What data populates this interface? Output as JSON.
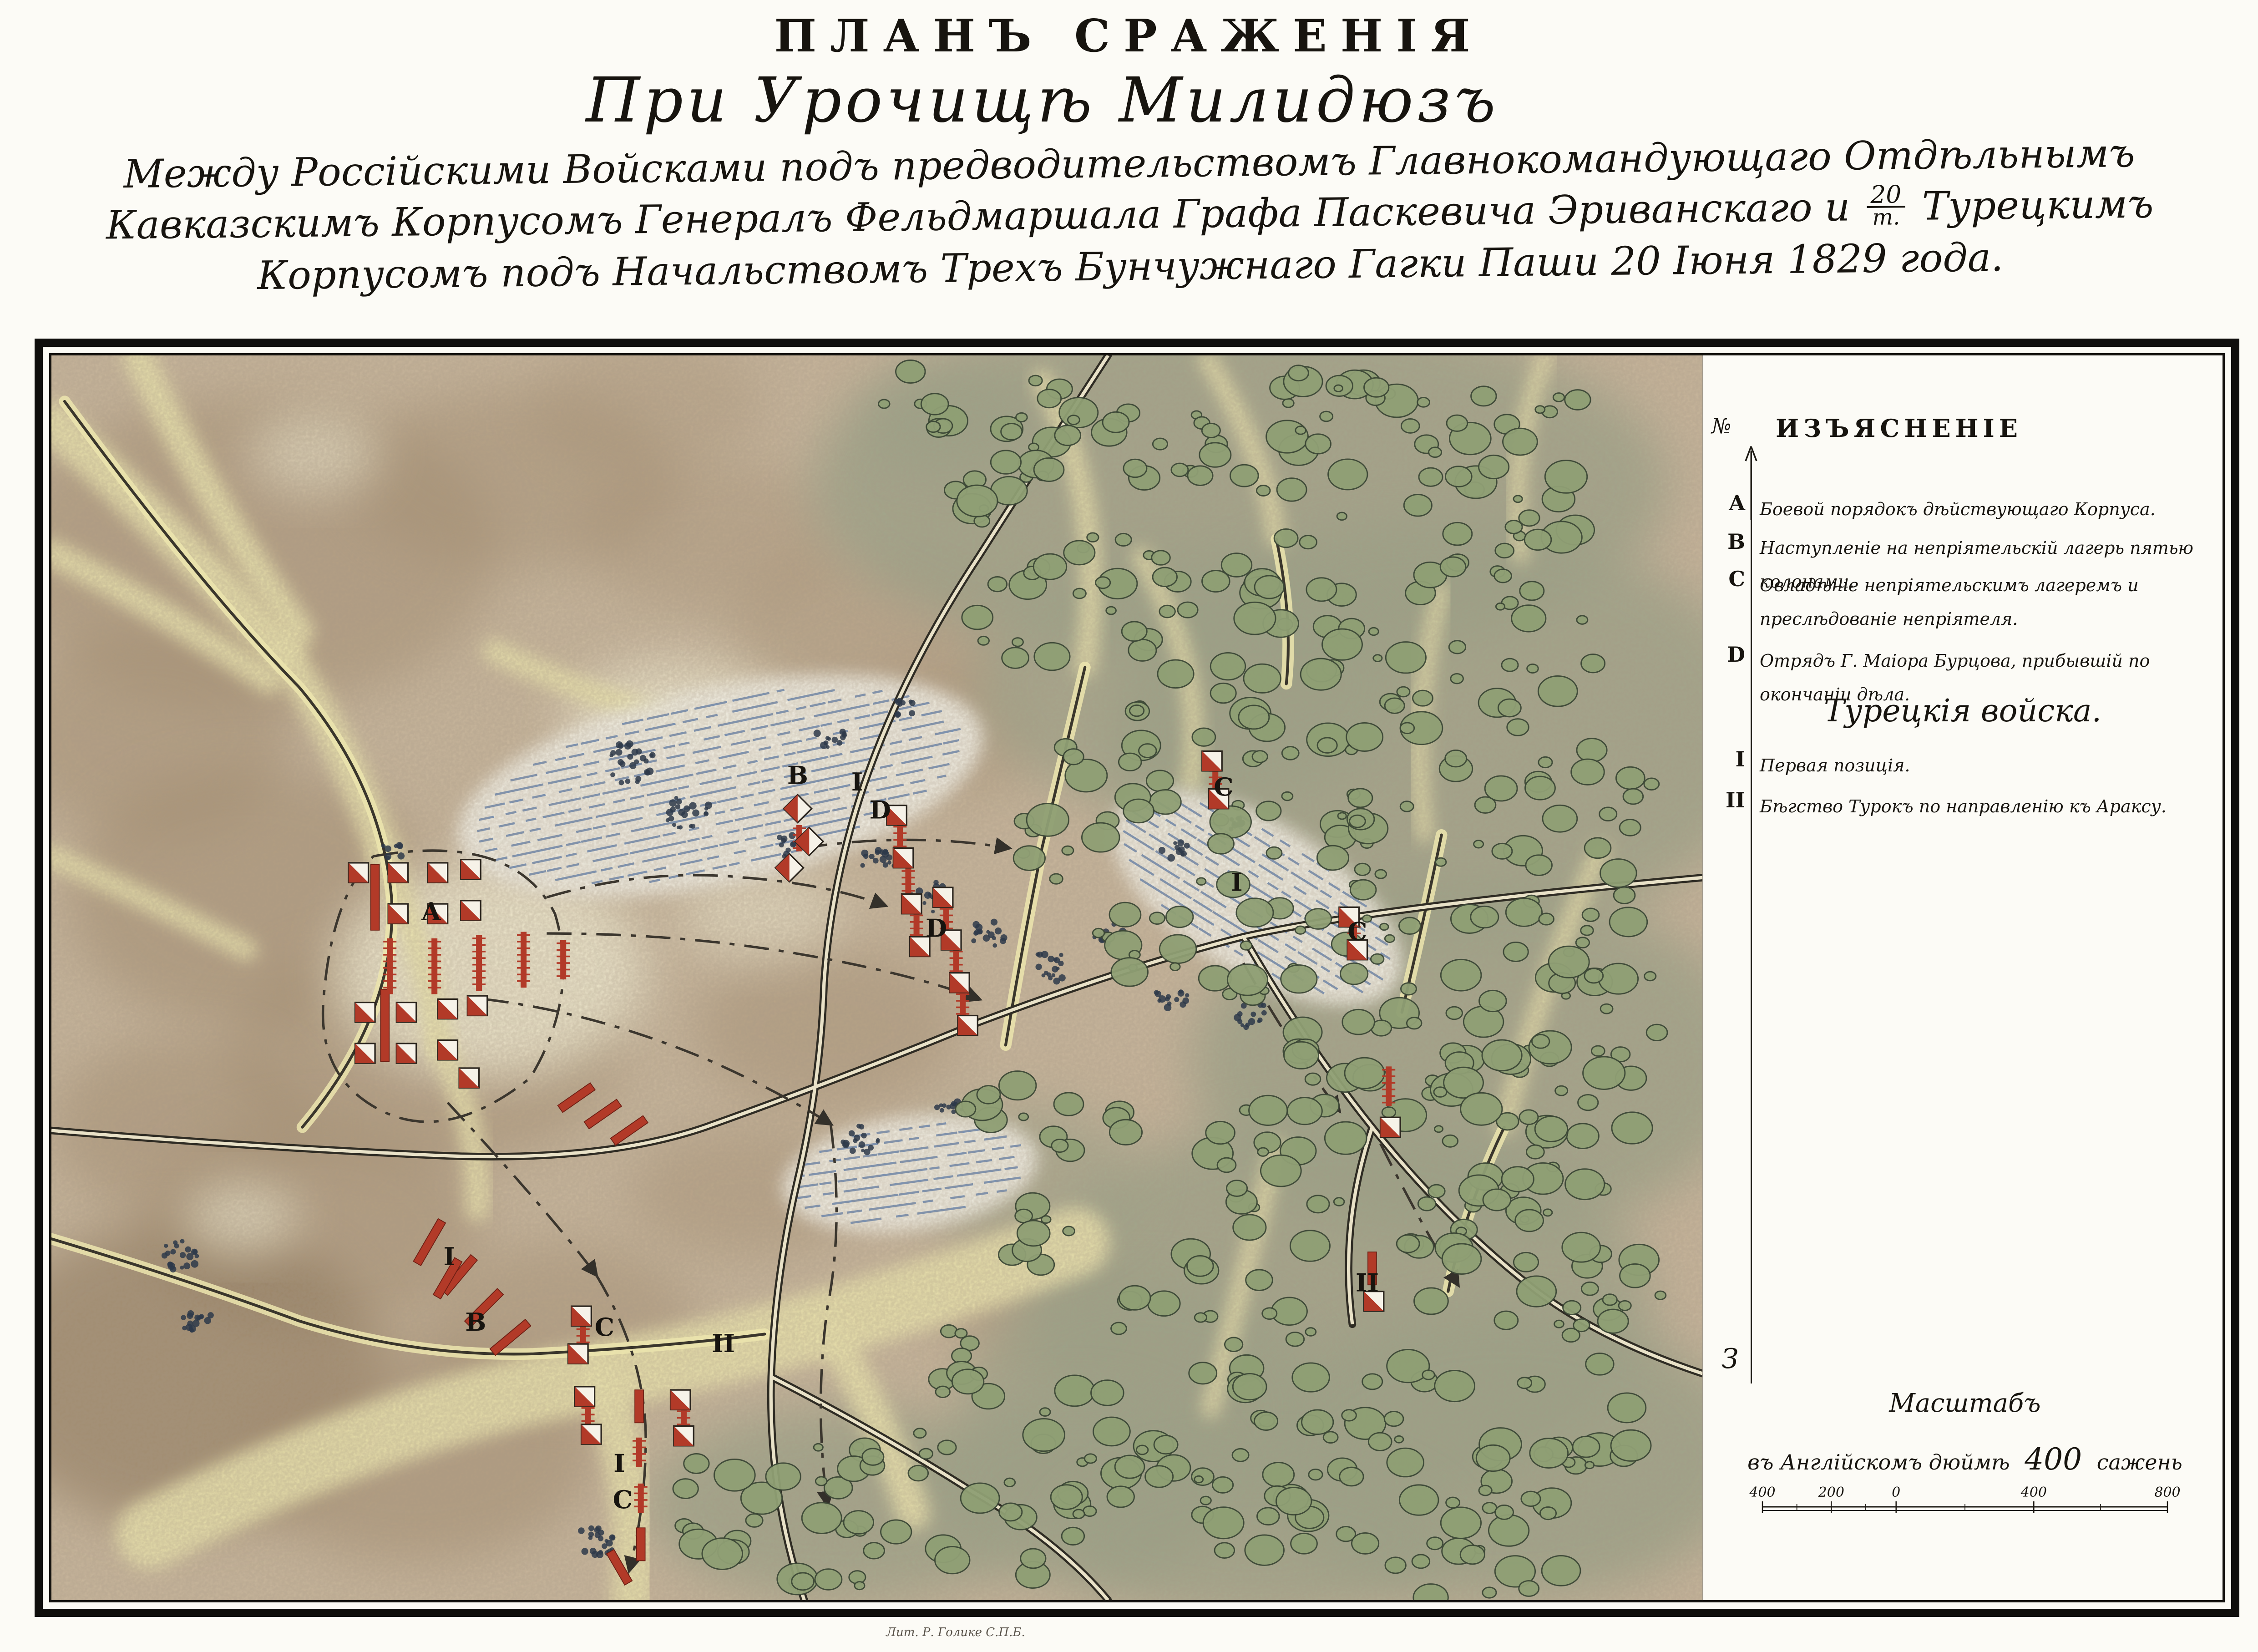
{
  "title_block": {
    "title": "ПЛАНЪ  СРАЖЕНІЯ",
    "subtitle": "При Урочищѣ  Милидюзъ",
    "line3": "Между Россійскими Войсками подъ предводительствомъ Главнокомандующаго Отдѣльнымъ",
    "line4_pre": "Кавказскимъ Корпусомъ Генералъ Фельдмаршала Графа Паскевича Эриванскаго и",
    "line4_frac_num": "20",
    "line4_frac_den": "т.",
    "line4_post": "Турецкимъ",
    "line5": "Корпусомъ подъ Начальствомъ Трехъ Бунчужнаго Гагки Паши  20 Іюня 1829 года."
  },
  "legend": {
    "north_label": "№",
    "header": "ИЗЪЯСНЕНІЕ",
    "items": [
      {
        "key": "A",
        "text": "Боевой порядокъ дѣйствующаго Корпуса."
      },
      {
        "key": "B",
        "text": "Наступленіе на непріятельскій лагерь пятью колонами."
      },
      {
        "key": "C",
        "text": "Овладѣніе непріятельскимъ лагеремъ и преслѣдованіе непріятеля."
      },
      {
        "key": "D",
        "text": "Отрядъ Г. Маіора Бурцова, прибывшій по окончаніи дѣла."
      }
    ],
    "subheader": "Турецкія войска.",
    "items2": [
      {
        "key": "I",
        "text": "Первая позиція."
      },
      {
        "key": "II",
        "text": "Бѣгство Турокъ по направленію къ Араксу."
      }
    ],
    "sheet_mark": "З"
  },
  "scale": {
    "title": "Масштабъ",
    "caption_pre": "въ Англійскомъ дюймѣ",
    "caption_value": "400",
    "caption_post": "сажень",
    "bar_labels": [
      [
        "400",
        0
      ],
      [
        "200",
        0.17
      ],
      [
        "0",
        0.33
      ],
      [
        "400",
        0.67
      ],
      [
        "800",
        1
      ]
    ],
    "minor_ticks": [
      0.085,
      0.255,
      0.5,
      0.835
    ]
  },
  "imprint": "Лит. Р. Голике С.П.Б.",
  "map": {
    "colors": {
      "terrain": "#c8b69c",
      "hill": "#a18a6d",
      "hill_dark": "#8a7356",
      "cream": "#f2ecd2",
      "valley": "#ece5ae",
      "forest_base": "#9aa287",
      "tree": "#8f9f74",
      "tree_outline": "#3c4836",
      "marsh_blue": "#7591b8",
      "marsh_ground": "#f6f4ea",
      "river": "#3a362c",
      "road": "#2f2c24",
      "road_fill": "#e9e2c8",
      "route": "#3b362e",
      "unit_red": "#b23a28",
      "flag_face": "#f6f2e8",
      "dot_scrub": "#2e3a4a",
      "label_ink": "#17140f"
    },
    "washes": [
      [
        120,
        120,
        150,
        95,
        "hill",
        0.5
      ],
      [
        280,
        75,
        100,
        55,
        "hill",
        0.45
      ],
      [
        60,
        230,
        85,
        65,
        "hill",
        0.5
      ],
      [
        120,
        330,
        110,
        80,
        "hill",
        0.55
      ],
      [
        225,
        425,
        120,
        70,
        "hill",
        0.5
      ],
      [
        80,
        470,
        80,
        55,
        "hill",
        0.5
      ],
      [
        160,
        530,
        100,
        65,
        "hill",
        0.55
      ],
      [
        80,
        620,
        120,
        95,
        "hill_dark",
        0.6
      ],
      [
        220,
        665,
        110,
        70,
        "hill",
        0.55
      ],
      [
        310,
        590,
        80,
        50,
        "hill",
        0.45
      ],
      [
        470,
        410,
        80,
        50,
        "hill",
        0.45
      ],
      [
        420,
        510,
        70,
        40,
        "hill",
        0.4
      ],
      [
        500,
        170,
        90,
        55,
        "hill",
        0.35
      ],
      [
        400,
        110,
        80,
        45,
        "hill",
        0.35
      ],
      [
        545,
        230,
        60,
        40,
        "hill",
        0.35
      ],
      [
        360,
        30,
        70,
        40,
        "hill",
        0.3
      ],
      [
        600,
        580,
        60,
        40,
        "hill",
        0.35
      ],
      [
        265,
        375,
        95,
        65,
        "cream",
        0.9
      ],
      [
        380,
        225,
        70,
        40,
        "cream",
        0.8
      ],
      [
        160,
        60,
        40,
        25,
        "cream",
        0.6
      ],
      [
        115,
        525,
        35,
        22,
        "cream",
        0.7
      ],
      [
        430,
        340,
        50,
        28,
        "cream",
        0.6
      ],
      [
        720,
        80,
        260,
        110,
        "forest_base",
        0.8
      ],
      [
        840,
        230,
        200,
        130,
        "forest_base",
        0.8
      ],
      [
        690,
        200,
        130,
        80,
        "forest_base",
        0.7
      ],
      [
        860,
        430,
        170,
        110,
        "forest_base",
        0.8
      ],
      [
        780,
        580,
        190,
        120,
        "forest_base",
        0.8
      ],
      [
        880,
        670,
        150,
        90,
        "forest_base",
        0.85
      ],
      [
        660,
        640,
        110,
        80,
        "forest_base",
        0.75
      ],
      [
        480,
        700,
        120,
        60,
        "forest_base",
        0.8
      ],
      [
        590,
        500,
        70,
        45,
        "forest_base",
        0.6
      ],
      [
        545,
        40,
        55,
        35,
        "forest_base",
        0.7
      ],
      [
        620,
        690,
        90,
        60,
        "forest_base",
        0.8
      ],
      [
        730,
        720,
        120,
        50,
        "forest_base",
        0.8
      ]
    ],
    "valleys": [
      [
        "M 0 40 Q 60 95 140 180",
        24
      ],
      [
        "M 52 0 Q 92 85 150 168",
        18
      ],
      [
        "M 0 120 Q 62 152 132 198",
        16
      ],
      [
        "M 140 180 Q 182 245 202 305",
        20
      ],
      [
        "M 0 305 Q 60 332 118 362",
        13
      ],
      [
        "M 202 305 Q 225 360 235 420",
        16
      ],
      [
        "M 60 718 Q 200 645 330 622 Q 470 596 620 540",
        42
      ],
      [
        "M 330 622 Q 358 680 352 756",
        26
      ],
      [
        "M 470 592 Q 502 645 522 705",
        20
      ],
      [
        "M 235 420 Q 260 470 258 520",
        14
      ],
      [
        "M 600 15 Q 640 90 626 190",
        12
      ],
      [
        "M 700 2 Q 736 62 742 112",
        10
      ],
      [
        "M 660 122 Q 700 192 690 262",
        10
      ],
      [
        "M 905 0 Q 882 62 890 122",
        9
      ],
      [
        "M 842 142 Q 822 222 832 292",
        9
      ],
      [
        "M 938 302 Q 902 382 880 470",
        10
      ],
      [
        "M 742 482 Q 722 562 702 642",
        10
      ],
      [
        "M 268 180 Q 330 210 390 225",
        14
      ],
      [
        "M 390 225 Q 470 240 520 262",
        12
      ]
    ],
    "marshes": [
      [
        405,
        262,
        150,
        52,
        -12
      ],
      [
        730,
        330,
        92,
        40,
        32
      ],
      [
        520,
        498,
        72,
        30,
        -8
      ]
    ],
    "rivers": [
      "M 8 28 Q 90 140 150 202 Q 200 262 206 330",
      "M 206 330 Q 210 400 152 470",
      "M 0 538 Q 80 562 150 588 Q 220 610 292 608 Q 370 604 432 596",
      "M 626 190 Q 612 250 600 300 Q 588 360 578 420",
      "M 842 292 Q 830 350 818 400",
      "M 880 470 Q 856 520 846 570",
      "M 742 112 Q 752 160 748 200"
    ],
    "roads": [
      "M 0 472 Q 120 482 230 487 Q 332 492 396 470 Q 480 440 562 406 Q 652 372 722 354 Q 802 336 1000 318",
      "M 640 0 Q 600 62 562 122 Q 516 192 492 262 Q 472 322 468 382 Q 466 442 452 502 Q 438 562 436 622 Q 434 692 456 758",
      "M 722 354 Q 760 420 800 470 Q 846 528 900 570 Q 940 600 1000 620",
      "M 436 622 Q 500 655 558 692 Q 610 722 640 758",
      "M 800 470 Q 780 530 788 590"
    ],
    "routes": [
      [
        "M 300 330 Q 360 312 420 318 Q 470 322 505 335",
        1
      ],
      [
        "M 300 352 Q 380 352 450 364 Q 520 376 562 392",
        1
      ],
      [
        "M 262 392 Q 330 400 400 430 Q 440 448 472 468",
        1
      ],
      [
        "M 455 300 Q 520 290 580 300",
        1
      ],
      [
        "M 240 455 Q 300 520 330 560",
        1
      ],
      [
        "M 330 560 Q 360 610 360 660 Q 360 700 350 740",
        1
      ],
      [
        "M 472 468 Q 480 530 470 580 Q 462 640 470 700",
        1
      ],
      [
        "M 722 370 Q 750 420 780 460",
        1
      ],
      [
        "M 805 480 Q 830 530 852 566",
        1
      ],
      [
        "M 195 305 Q 280 290 305 340 Q 320 390 290 440 Q 240 480 200 460 Q 160 440 165 390 Q 170 330 195 305",
        0
      ]
    ],
    "forests": [
      [
        640,
        45,
        75,
        40,
        26
      ],
      [
        760,
        55,
        90,
        45,
        30
      ],
      [
        890,
        70,
        70,
        50,
        26
      ],
      [
        620,
        150,
        65,
        50,
        24
      ],
      [
        735,
        165,
        80,
        55,
        28
      ],
      [
        865,
        180,
        70,
        55,
        26
      ],
      [
        680,
        255,
        70,
        50,
        24
      ],
      [
        800,
        270,
        75,
        55,
        26
      ],
      [
        920,
        285,
        55,
        55,
        20
      ],
      [
        745,
        350,
        65,
        45,
        22
      ],
      [
        865,
        385,
        70,
        55,
        24
      ],
      [
        950,
        390,
        40,
        55,
        16
      ],
      [
        800,
        440,
        60,
        45,
        20
      ],
      [
        905,
        470,
        60,
        55,
        20
      ],
      [
        745,
        500,
        55,
        45,
        18
      ],
      [
        855,
        545,
        65,
        55,
        22
      ],
      [
        950,
        575,
        40,
        55,
        16
      ],
      [
        700,
        590,
        55,
        45,
        18
      ],
      [
        790,
        640,
        65,
        50,
        22
      ],
      [
        910,
        660,
        55,
        45,
        18
      ],
      [
        745,
        700,
        65,
        40,
        20
      ],
      [
        860,
        725,
        65,
        35,
        20
      ],
      [
        640,
        665,
        50,
        40,
        16
      ],
      [
        580,
        710,
        50,
        35,
        14
      ],
      [
        420,
        700,
        45,
        35,
        12
      ],
      [
        500,
        665,
        45,
        35,
        12
      ],
      [
        475,
        730,
        45,
        25,
        12
      ],
      [
        545,
        620,
        35,
        28,
        10
      ],
      [
        600,
        530,
        28,
        24,
        8
      ],
      [
        628,
        470,
        24,
        20,
        7
      ],
      [
        575,
        455,
        22,
        18,
        6
      ],
      [
        532,
        30,
        30,
        25,
        8
      ],
      [
        568,
        90,
        26,
        22,
        7
      ],
      [
        660,
        360,
        40,
        30,
        10
      ],
      [
        610,
        300,
        30,
        25,
        8
      ]
    ],
    "dots": [
      [
        350,
        248,
        16,
        26
      ],
      [
        385,
        278,
        14,
        22
      ],
      [
        448,
        298,
        10,
        14
      ],
      [
        500,
        308,
        11,
        16
      ],
      [
        532,
        330,
        12,
        18
      ],
      [
        568,
        352,
        11,
        16
      ],
      [
        605,
        372,
        12,
        18
      ],
      [
        640,
        352,
        9,
        12
      ],
      [
        678,
        390,
        10,
        14
      ],
      [
        728,
        402,
        10,
        14
      ],
      [
        206,
        302,
        7,
        8
      ],
      [
        78,
        548,
        12,
        20
      ],
      [
        88,
        588,
        10,
        16
      ],
      [
        330,
        722,
        12,
        22
      ],
      [
        490,
        478,
        11,
        16
      ],
      [
        545,
        458,
        9,
        12
      ],
      [
        472,
        232,
        9,
        12
      ],
      [
        518,
        214,
        8,
        10
      ],
      [
        680,
        300,
        8,
        10
      ],
      [
        715,
        285,
        7,
        8
      ]
    ],
    "units": {
      "flags": [
        [
          186,
          315,
          0
        ],
        [
          210,
          315,
          0
        ],
        [
          234,
          315,
          0
        ],
        [
          254,
          313,
          0
        ],
        [
          210,
          340,
          0
        ],
        [
          234,
          340,
          0
        ],
        [
          254,
          338,
          0
        ],
        [
          190,
          400,
          0
        ],
        [
          215,
          400,
          0
        ],
        [
          240,
          398,
          0
        ],
        [
          258,
          396,
          0
        ],
        [
          190,
          425,
          0
        ],
        [
          215,
          425,
          0
        ],
        [
          240,
          423,
          0
        ],
        [
          253,
          440,
          0
        ],
        [
          321,
          585,
          0
        ],
        [
          319,
          608,
          0
        ],
        [
          323,
          634,
          0
        ],
        [
          327,
          657,
          0
        ],
        [
          381,
          636,
          0
        ],
        [
          383,
          658,
          0
        ],
        [
          452,
          276,
          45
        ],
        [
          459,
          296,
          45
        ],
        [
          447,
          312,
          45
        ],
        [
          512,
          280,
          0
        ],
        [
          516,
          306,
          0
        ],
        [
          521,
          334,
          0
        ],
        [
          526,
          360,
          0
        ],
        [
          540,
          330,
          0
        ],
        [
          545,
          356,
          0
        ],
        [
          550,
          382,
          0
        ],
        [
          555,
          408,
          0
        ],
        [
          703,
          247,
          0
        ],
        [
          707,
          270,
          0
        ],
        [
          786,
          342,
          0
        ],
        [
          791,
          362,
          0
        ],
        [
          811,
          470,
          0
        ],
        [
          801,
          576,
          0
        ]
      ],
      "bars": [
        [
          196,
          330,
          90,
          40
        ],
        [
          202,
          408,
          90,
          44
        ],
        [
          318,
          452,
          -35,
          24
        ],
        [
          334,
          462,
          -35,
          24
        ],
        [
          350,
          472,
          -35,
          24
        ],
        [
          247,
          560,
          -50,
          28
        ],
        [
          262,
          580,
          -45,
          28
        ],
        [
          278,
          598,
          -40,
          28
        ],
        [
          229,
          540,
          -60,
          30
        ],
        [
          240,
          562,
          -60,
          26
        ],
        [
          344,
          738,
          60,
          22
        ],
        [
          357,
          724,
          90,
          20
        ],
        [
          356,
          640,
          90,
          20
        ],
        [
          800,
          556,
          90,
          20
        ]
      ],
      "hbars": [
        [
          205,
          372,
          90,
          34
        ],
        [
          232,
          372,
          90,
          34
        ],
        [
          259,
          370,
          90,
          34
        ],
        [
          286,
          368,
          90,
          34
        ],
        [
          310,
          368,
          90,
          24
        ],
        [
          514,
          293,
          90,
          16
        ],
        [
          519,
          320,
          90,
          16
        ],
        [
          524,
          347,
          90,
          16
        ],
        [
          542,
          343,
          90,
          16
        ],
        [
          548,
          369,
          90,
          16
        ],
        [
          552,
          395,
          90,
          16
        ],
        [
          453,
          294,
          90,
          16
        ],
        [
          705,
          258,
          90,
          14
        ],
        [
          789,
          352,
          90,
          12
        ],
        [
          810,
          445,
          90,
          24
        ],
        [
          322,
          597,
          90,
          12
        ],
        [
          325,
          645,
          90,
          12
        ],
        [
          383,
          648,
          90,
          14
        ],
        [
          356,
          668,
          90,
          18
        ],
        [
          357,
          696,
          90,
          18
        ]
      ]
    },
    "labels": [
      [
        "A",
        230,
        344
      ],
      [
        "B",
        452,
        261
      ],
      [
        "I",
        488,
        265
      ],
      [
        "D",
        502,
        282
      ],
      [
        "D",
        536,
        354
      ],
      [
        "C",
        710,
        268
      ],
      [
        "I",
        718,
        326
      ],
      [
        "C",
        791,
        356
      ],
      [
        "I",
        241,
        554
      ],
      [
        "B",
        257,
        594
      ],
      [
        "C",
        335,
        597
      ],
      [
        "II",
        407,
        607
      ],
      [
        "II",
        797,
        570
      ],
      [
        "I",
        344,
        680
      ],
      [
        "C",
        346,
        702
      ]
    ]
  }
}
